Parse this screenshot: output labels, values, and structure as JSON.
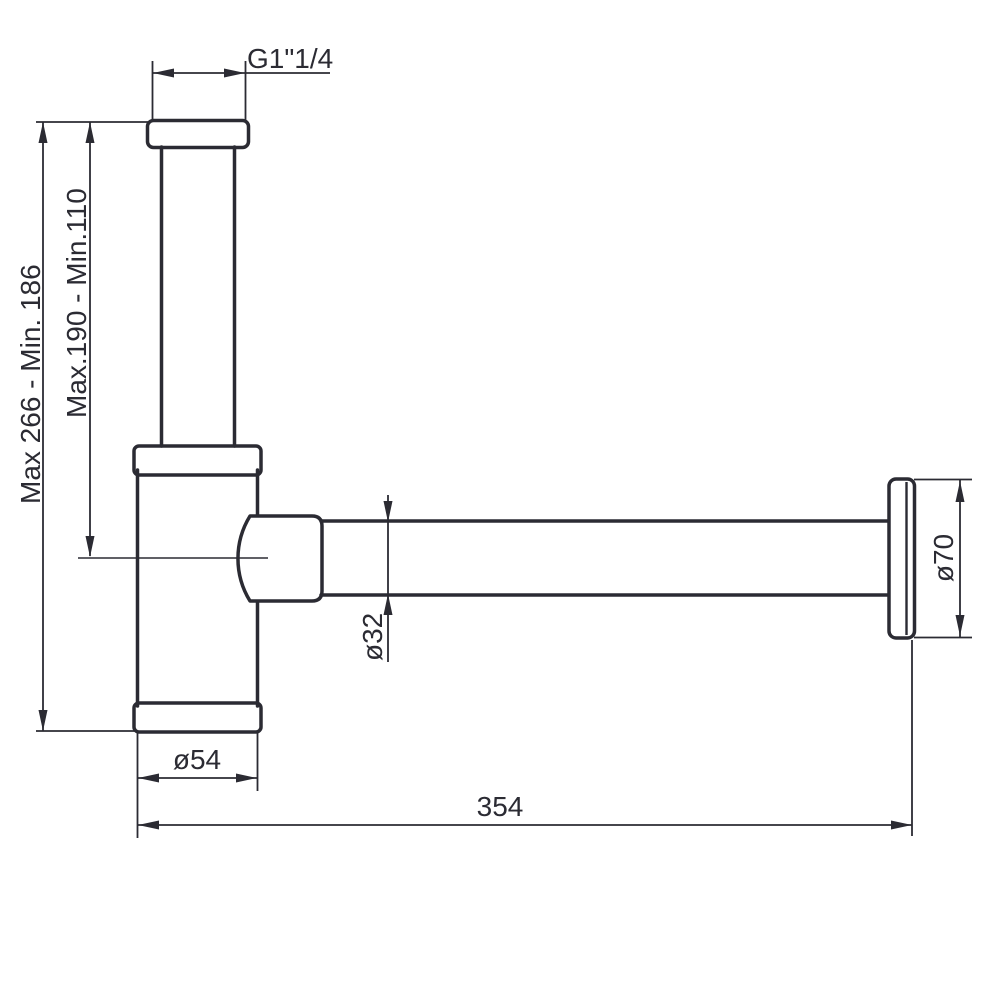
{
  "drawing": {
    "labels": {
      "thread": "G1\"1/4",
      "overall_height": "Max 266 - Min. 186",
      "inlet_height": "Max.190 - Min.110",
      "body_diameter": "ø54",
      "pipe_diameter": "ø32",
      "flange_diameter": "ø70",
      "length": "354"
    }
  }
}
